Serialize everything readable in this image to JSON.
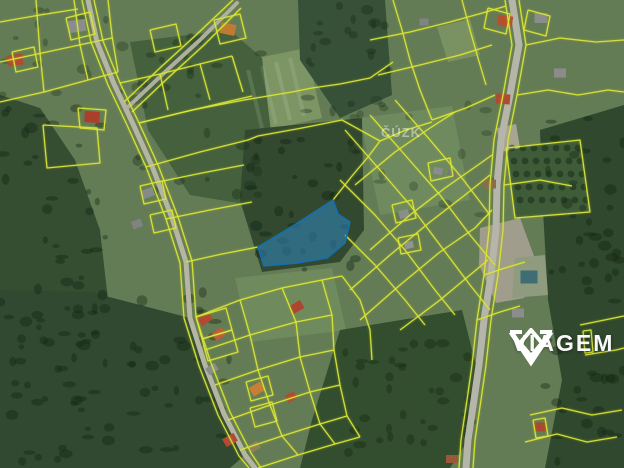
{
  "watermarks": {
    "cuzk": "ČÚZK",
    "brand": "VIAGEM"
  },
  "colors": {
    "base": "#647c55",
    "cadastral_line": "#dde63c",
    "parcel_fill": "rgba(50,135,195,0.55)",
    "parcel_stroke": "#1470ad",
    "road": "#b6b5a4",
    "logo_white": "#ffffff"
  },
  "map": {
    "base_color": "#647c55",
    "meadows": [
      {
        "name": "meadow-top-center",
        "points": "238,62 306,48 322,118 254,133",
        "fill": "#7d9465"
      },
      {
        "name": "meadow-top-right",
        "points": "437,27 470,19 480,55 448,62",
        "fill": "#7a9162"
      },
      {
        "name": "meadow-right-center",
        "points": "360,118 452,106 470,200 380,215",
        "fill": "#6f8a5e"
      },
      {
        "name": "meadow-below-parcel",
        "points": "235,278 332,268 346,330 250,342",
        "fill": "#6f8a5c"
      }
    ],
    "forests": [
      {
        "name": "forest-left",
        "points": "0,95 40,108 75,160 100,230 108,300 60,330 0,315",
        "fill": "#354d31"
      },
      {
        "name": "forest-bottom-left",
        "points": "0,290 90,292 190,318 205,365 225,415 245,455 230,468 0,468",
        "fill": "#314930"
      },
      {
        "name": "forest-center-left",
        "points": "130,42 230,30 262,58 272,140 250,205 190,195 148,130",
        "fill": "#44603c"
      },
      {
        "name": "forest-central",
        "points": "245,130 362,118 364,230 340,262 262,272 240,200",
        "fill": "#32492f"
      },
      {
        "name": "forest-top-center",
        "points": "298,0 385,0 392,95 340,118 300,60",
        "fill": "#365137"
      },
      {
        "name": "forest-right-strip",
        "points": "540,130 624,105 624,468 545,468 562,380 548,300 543,210",
        "fill": "#30482d"
      },
      {
        "name": "forest-bottom-right",
        "points": "340,330 462,310 476,365 468,440 450,468 300,468 312,420",
        "fill": "#334e2e"
      },
      {
        "name": "orchard",
        "points": "506,148 580,140 590,212 515,218",
        "fill": "#3f5c39"
      },
      {
        "name": "dirt-patch",
        "points": "480,228 520,218 534,256 524,298 496,303 479,265",
        "fill": "#a09d8c"
      },
      {
        "name": "clearing",
        "points": "515,258 545,255 548,295 512,298",
        "fill": "#8f9b7f"
      },
      {
        "name": "dirt-road-bend",
        "points": "497,128 516,124 520,148 500,152",
        "fill": "#a8a595"
      }
    ],
    "texture_zones": [
      {
        "x": 0,
        "y": 100,
        "w": 115,
        "h": 350,
        "count": 60,
        "fill": "rgba(18,35,18,0.38)"
      },
      {
        "x": 0,
        "y": 290,
        "w": 230,
        "h": 175,
        "count": 55,
        "fill": "rgba(18,35,18,0.38)"
      },
      {
        "x": 545,
        "y": 110,
        "w": 79,
        "h": 355,
        "count": 55,
        "fill": "rgba(18,35,18,0.38)"
      },
      {
        "x": 250,
        "y": 125,
        "w": 110,
        "h": 145,
        "count": 30,
        "fill": "rgba(16,34,18,0.40)"
      },
      {
        "x": 135,
        "y": 35,
        "w": 130,
        "h": 165,
        "count": 28,
        "fill": "rgba(24,44,24,0.35)"
      },
      {
        "x": 300,
        "y": 0,
        "w": 90,
        "h": 115,
        "count": 22,
        "fill": "rgba(20,40,20,0.35)"
      },
      {
        "x": 345,
        "y": 335,
        "w": 125,
        "h": 130,
        "count": 35,
        "fill": "rgba(18,38,18,0.36)"
      },
      {
        "x": 350,
        "y": 100,
        "w": 160,
        "h": 120,
        "count": 18,
        "fill": "rgba(30,50,30,0.30)"
      },
      {
        "x": 0,
        "y": 0,
        "w": 140,
        "h": 100,
        "count": 18,
        "fill": "rgba(28,48,28,0.32)"
      }
    ],
    "orchard_grid": {
      "x0": 512,
      "y0": 148,
      "cols": 7,
      "rows": 5,
      "dx": 11,
      "dy": 13,
      "r": 3.4,
      "fill": "rgba(24,44,24,0.55)"
    },
    "field_stripes": [
      {
        "points": "248,70 262,128",
        "color": "rgba(225,235,205,0.14)",
        "width": 4
      },
      {
        "points": "262,66 276,124",
        "color": "rgba(225,235,205,0.12)",
        "width": 4
      },
      {
        "points": "276,62 290,120",
        "color": "rgba(225,235,205,0.14)",
        "width": 4
      },
      {
        "points": "290,58 304,116",
        "color": "rgba(225,235,205,0.12)",
        "width": 4
      }
    ],
    "roads": [
      {
        "name": "road-left-main",
        "points": "88,0 97,42 114,84 133,124 152,166 172,218 186,262 190,318 205,365 224,414 245,455 255,468",
        "width": 5,
        "color": "#b6b5a4"
      },
      {
        "name": "road-branch-topleft",
        "points": "128,107 165,72 200,40 237,3",
        "width": 4,
        "color": "#b0ae9e"
      },
      {
        "name": "road-right-main",
        "points": "512,0 519,45 510,95 501,140 497,185 496,230 491,275 484,320 479,365 474,400 468,440 466,468",
        "width": 7,
        "color": "#b5b5aa"
      }
    ],
    "buildings": [
      {
        "cx": 15,
        "cy": 60,
        "w": 16,
        "h": 11,
        "rot": -8,
        "fill": "#b04a32"
      },
      {
        "cx": 77,
        "cy": 26,
        "w": 17,
        "h": 12,
        "rot": -8,
        "fill": "#8a8d8c"
      },
      {
        "cx": 92,
        "cy": 117,
        "w": 15,
        "h": 11,
        "rot": 5,
        "fill": "#aa3f2c"
      },
      {
        "cx": 228,
        "cy": 29,
        "w": 15,
        "h": 11,
        "rot": 12,
        "fill": "#bf7a33"
      },
      {
        "cx": 148,
        "cy": 193,
        "w": 12,
        "h": 9,
        "rot": -20,
        "fill": "#868a88"
      },
      {
        "cx": 137,
        "cy": 224,
        "w": 10,
        "h": 8,
        "rot": -20,
        "fill": "#7f8382"
      },
      {
        "cx": 205,
        "cy": 319,
        "w": 13,
        "h": 9,
        "rot": -35,
        "fill": "#b04a32"
      },
      {
        "cx": 219,
        "cy": 334,
        "w": 12,
        "h": 9,
        "rot": -35,
        "fill": "#c05a3a"
      },
      {
        "cx": 212,
        "cy": 369,
        "w": 11,
        "h": 8,
        "rot": -35,
        "fill": "#8a8d8c"
      },
      {
        "cx": 257,
        "cy": 389,
        "w": 13,
        "h": 10,
        "rot": -30,
        "fill": "#c87f35"
      },
      {
        "cx": 291,
        "cy": 397,
        "w": 10,
        "h": 8,
        "rot": -30,
        "fill": "#b04a32"
      },
      {
        "cx": 297,
        "cy": 307,
        "w": 12,
        "h": 9,
        "rot": -30,
        "fill": "#ad4530"
      },
      {
        "cx": 230,
        "cy": 440,
        "w": 13,
        "h": 9,
        "rot": -30,
        "fill": "#b04a32"
      },
      {
        "cx": 254,
        "cy": 447,
        "w": 11,
        "h": 8,
        "rot": -30,
        "fill": "#8f7f5f"
      },
      {
        "cx": 505,
        "cy": 21,
        "w": 15,
        "h": 11,
        "rot": 8,
        "fill": "#b5502f"
      },
      {
        "cx": 541,
        "cy": 18,
        "w": 13,
        "h": 10,
        "rot": 0,
        "fill": "#8a8d8c"
      },
      {
        "cx": 503,
        "cy": 99,
        "w": 14,
        "h": 10,
        "rot": 5,
        "fill": "#b04a32"
      },
      {
        "cx": 560,
        "cy": 73,
        "w": 12,
        "h": 9,
        "rot": 0,
        "fill": "#8a8d8c"
      },
      {
        "cx": 490,
        "cy": 184,
        "w": 12,
        "h": 9,
        "rot": 0,
        "fill": "#8d6b4a"
      },
      {
        "cx": 529,
        "cy": 277,
        "w": 17,
        "h": 13,
        "rot": 0,
        "fill": "#3e6d74"
      },
      {
        "cx": 518,
        "cy": 313,
        "w": 12,
        "h": 9,
        "rot": 0,
        "fill": "#8a8d8c"
      },
      {
        "cx": 540,
        "cy": 427,
        "w": 12,
        "h": 9,
        "rot": 0,
        "fill": "#a84a30"
      },
      {
        "cx": 452,
        "cy": 459,
        "w": 12,
        "h": 8,
        "rot": 0,
        "fill": "#9a5838"
      },
      {
        "cx": 404,
        "cy": 214,
        "w": 10,
        "h": 8,
        "rot": -15,
        "fill": "#8a8d8c"
      },
      {
        "cx": 409,
        "cy": 245,
        "w": 9,
        "h": 7,
        "rot": -15,
        "fill": "#90938f"
      },
      {
        "cx": 438,
        "cy": 171,
        "w": 9,
        "h": 7,
        "rot": 10,
        "fill": "#8a8d8c"
      },
      {
        "cx": 452,
        "cy": 174,
        "w": 8,
        "h": 6,
        "rot": 10,
        "fill": "#75787a"
      },
      {
        "cx": 424,
        "cy": 22,
        "w": 9,
        "h": 7,
        "rot": 0,
        "fill": "#808584"
      }
    ],
    "cadastral_lines": [
      "82,0 91,42 108,85 127,125 146,167 166,219 180,263 184,318 199,366 218,415 239,456 249,468",
      "94,0 103,41 120,83 139,123 158,165 178,217 192,261 196,317 211,363 230,412 251,453 261,468",
      "124,102 161,67 196,35 233,0",
      "132,112 169,77 204,45 241,8",
      "505,0 512,45 503,95 494,140 490,185 489,230 484,275 477,320 472,365 467,400 461,440 459,468",
      "519,0 526,45 517,95 508,140 504,185 503,230 498,275 491,320 486,365 481,400 475,440 473,468",
      "0,22 40,15 78,9",
      "0,62 42,53 84,44 112,38",
      "0,102 44,92 88,80 118,72",
      "36,0 40,53 44,92",
      "74,0 80,45 88,80",
      "108,0 112,36 118,72",
      "120,83 160,74 200,64 232,56",
      "139,123 180,113 222,103 252,96",
      "160,74 168,110",
      "200,64 210,100",
      "232,56 243,92",
      "214,20 240,14 246,38 220,44 214,20",
      "150,30 176,24 181,46 155,52 150,30",
      "12,52 34,47 38,67 16,72 12,52",
      "66,18 90,12 95,34 71,40 66,18",
      "43,125 97,128 100,163 47,168 43,125",
      "78,108 106,110 104,130 80,128 78,108",
      "146,167 200,152 248,140 258,136",
      "158,182 202,173 244,165",
      "166,219 210,210 252,202",
      "186,262 222,254 258,247",
      "140,186 162,181 166,199 144,204 140,186",
      "150,215 172,210 176,228 154,233 150,215",
      "139,123 192,110 244,100 292,92 312,88",
      "258,136 302,128 342,120 380,141",
      "333,200 352,176 368,157 380,141",
      "380,141 406,130 432,122",
      "312,88 340,84 370,78 393,62",
      "393,0 402,30 410,60 420,90 432,120",
      "370,40 410,32 450,22 486,12 506,6",
      "378,75 420,65 460,55 492,45",
      "432,120 466,108 495,95",
      "462,0 470,30 478,58 486,85",
      "488,8 510,14 506,34 484,28 488,8",
      "528,10 550,16 546,36 524,30 528,10",
      "345,130 380,170 410,205 440,245 470,285 490,310",
      "370,115 405,155 440,195 470,235 495,265",
      "395,100 430,140 462,178 490,215",
      "340,180 375,215 405,250 435,290 455,315",
      "345,235 375,265 405,300 425,325",
      "350,290 390,255 430,222 465,195 490,175",
      "360,320 400,285 440,252 475,228 492,210",
      "355,185 395,152 430,128 455,112",
      "370,250 410,215 445,188 478,165 492,155",
      "400,330 440,300 470,275 488,260",
      "392,205 412,200 416,218 396,223 392,205",
      "398,238 418,234 421,250 401,254 398,238",
      "428,163 450,158 453,176 431,181 428,163",
      "526,45 560,38 596,42 624,40",
      "517,95 548,90 578,95 608,90 624,92",
      "504,185 540,180 572,186",
      "506,148 580,140 590,212 515,218 506,148",
      "580,325 624,316",
      "585,355 616,350 624,348",
      "583,331 591,330 593,352 585,353 583,331",
      "530,415 562,408 592,415 622,410",
      "525,442 557,434 587,442 617,437",
      "533,420 545,418 548,436 536,438 533,420",
      "196,317 240,300 282,288 322,280 342,276",
      "205,350 250,335 296,322 332,315",
      "215,385 258,370 300,357 334,350",
      "228,420 270,405 310,392 340,385",
      "240,450 282,436 320,424 347,416",
      "258,468 298,455 335,444 360,437",
      "240,300 250,335 258,370 270,405 282,436 298,455",
      "282,288 296,322 300,357 310,392 320,424 335,444",
      "322,280 332,315 334,350 340,385 347,416 360,437",
      "196,317 226,308 232,330 202,339 196,317",
      "202,339 232,330 238,352 208,361 202,339",
      "246,382 268,376 273,395 251,401 246,382",
      "250,408 272,402 277,421 255,427 250,408",
      "342,276 360,300 370,330 372,360",
      "477,320 500,312 520,306",
      "484,275 505,268 525,262"
    ],
    "highlight_parcel": {
      "points": "258,247 296,224 333,200 338,214 350,222 345,243 327,258 298,263 264,266",
      "fill": "rgba(50,135,195,0.55)",
      "stroke": "#1470ad"
    }
  }
}
